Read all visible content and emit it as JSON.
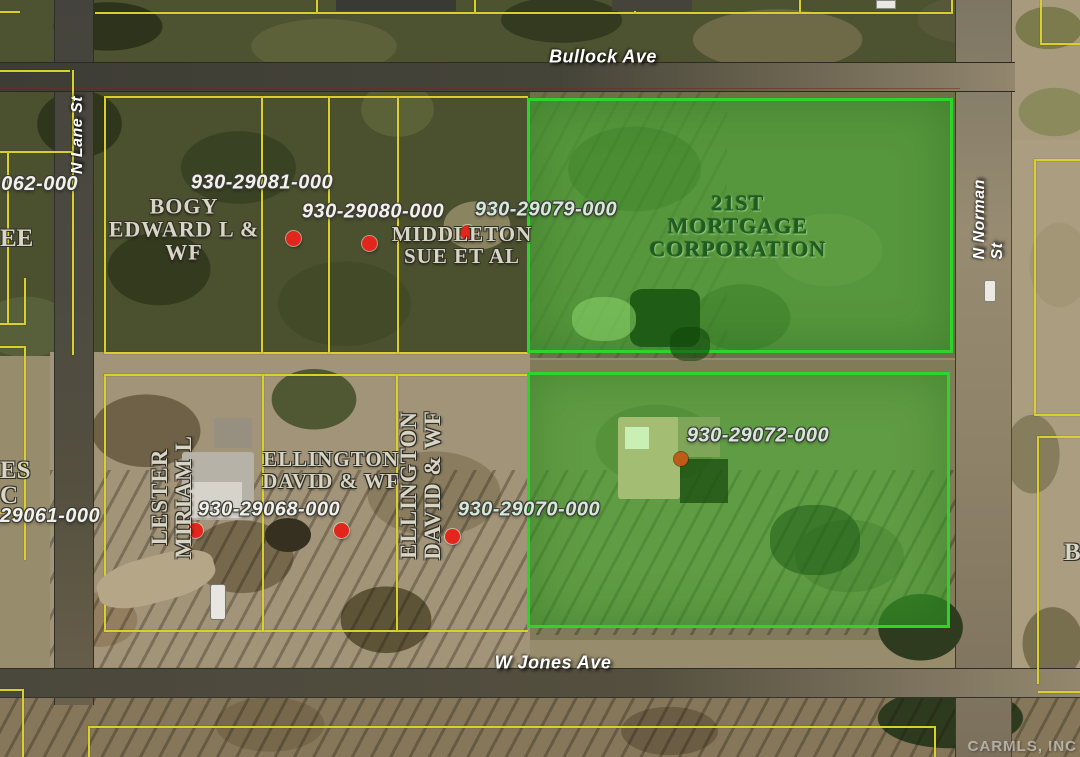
{
  "map": {
    "streets": {
      "bullock": "Bullock Ave",
      "lane": "N Lane St",
      "norman": "N Norman St",
      "jones": "W Jones Ave"
    },
    "parcel_numbers": {
      "p29081": "930-29081-000",
      "p29080": "930-29080-000",
      "p29079": "930-29079-000",
      "p29072": "930-29072-000",
      "p29070": "930-29070-000",
      "p29068": "930-29068-000"
    },
    "owners": {
      "bogy": "BOGY\nEDWARD L &\nWF",
      "middleton": "MIDDLETON\nSUE ET AL",
      "mortgage": "21ST\nMORTGAGE\nCORPORATION",
      "ellington_h": "ELLINGTON\nDAVID & WF",
      "ellington_v": "ELLINGTON\nDAVID & WF",
      "lester": "LESTER\nMIRIAM L"
    },
    "edge_fragments": {
      "num_062": "-062-000",
      "num_29061": "29061-000",
      "ee": "EE",
      "es_c": "ES\nC",
      "b": "B"
    },
    "highlighted_parcels": [
      {
        "owner": "21ST MORTGAGE CORPORATION",
        "number": "930-29079-000"
      },
      {
        "owner": "",
        "number": "930-29072-000"
      }
    ],
    "markers": {
      "red_parcel_point_count": 6,
      "red_parcel_point_color": "#e3261c",
      "selected_point_color": "#bf5a17"
    },
    "colors": {
      "parcel_line": "#d9d02b",
      "highlight_border": "#2bd52b",
      "highlight_fill": "rgba(62,190,46,0.5)"
    }
  },
  "watermark": "CARMLS, INC"
}
